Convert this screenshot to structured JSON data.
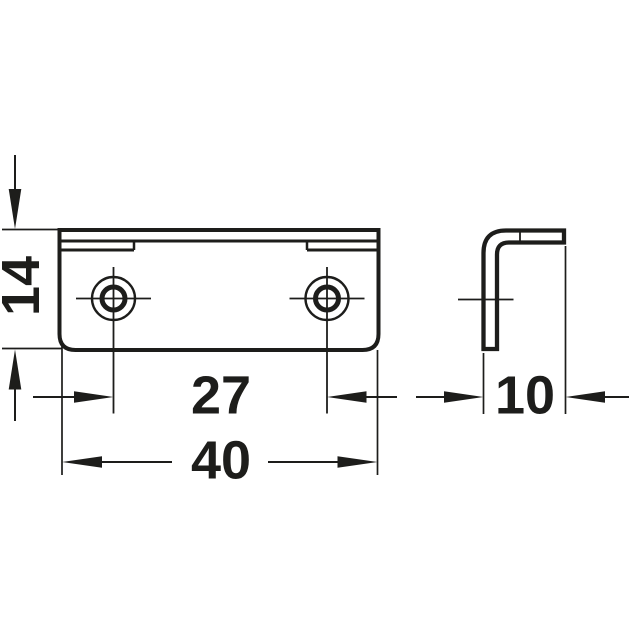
{
  "drawing": {
    "background_color": "#ffffff",
    "line_color": "#1d1d1b",
    "dimensions": {
      "height": "14",
      "hole_spacing": "27",
      "width": "40",
      "depth": "10"
    }
  }
}
